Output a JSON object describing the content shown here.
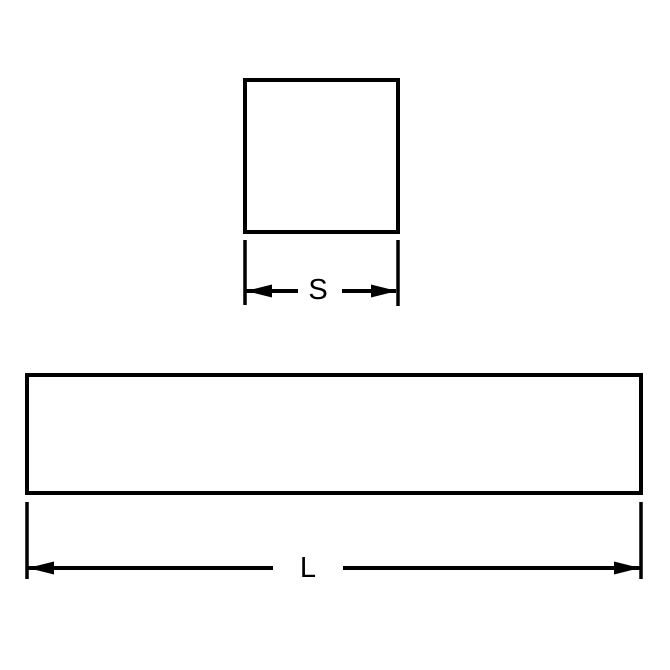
{
  "diagram": {
    "type": "technical-drawing",
    "background_color": "#ffffff",
    "line_color": "#000000",
    "views": {
      "square_cross_section": {
        "dimension_label": "S"
      },
      "bar_side_profile": {
        "dimension_label": "L"
      }
    }
  }
}
